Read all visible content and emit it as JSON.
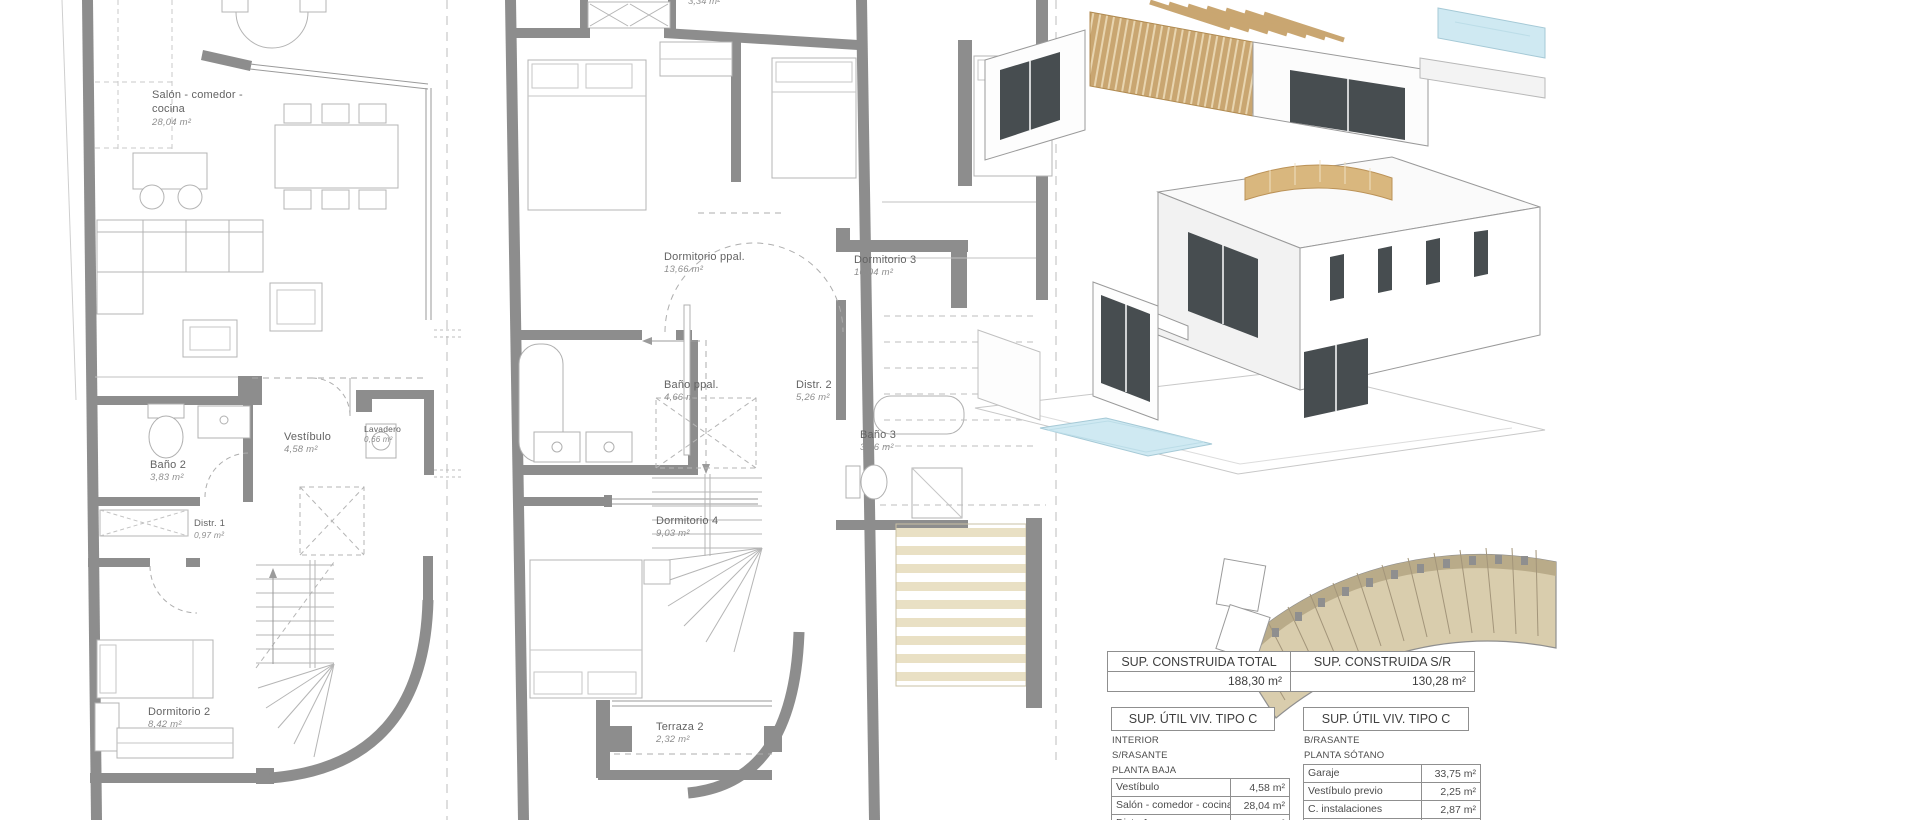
{
  "document": {
    "kind": "architectural plan sheet, vivienda tipo C"
  },
  "colors": {
    "wall": "#8d8d8d",
    "line": "#b4b4b4",
    "dash": "#adadad",
    "label": "#636363",
    "area_text": "#8e8e8e",
    "wood": "#c9a671",
    "roof_wood": "#d9b77e",
    "pool": "#cfe9f2",
    "glass": "#474d50",
    "site_beige": "#d9cdad",
    "stair_beige": "#e9e0c4"
  },
  "plans": {
    "ground": {
      "rooms": [
        {
          "name": "Salón - comedor - cocina",
          "area": "28,04 m²"
        },
        {
          "name": "Baño 2",
          "area": "3,83 m²"
        },
        {
          "name": "Vestíbulo",
          "area": "4,58 m²"
        },
        {
          "name": "Lavadero",
          "area": "0,66 m²"
        },
        {
          "name": "Distr. 1",
          "area": "0,97 m²"
        },
        {
          "name": "Dormitorio 2",
          "area": "8,42 m²"
        }
      ]
    },
    "upper": {
      "partial_area": "3,34 m²",
      "rooms": [
        {
          "name": "Dormitorio ppal.",
          "area": "13,66 m²"
        },
        {
          "name": "Dormitorio 3",
          "area": "10,04 m²"
        },
        {
          "name": "Baño ppal.",
          "area": "4,66 m²"
        },
        {
          "name": "Distr. 2",
          "area": "5,26 m²"
        },
        {
          "name": "Baño 3",
          "area": "3,36 m²"
        },
        {
          "name": "Dormitorio 4",
          "area": "9,03 m²"
        },
        {
          "name": "Terraza 2",
          "area": "2,32 m²"
        }
      ]
    }
  },
  "tables": {
    "summary": {
      "col1_header": "SUP. CONSTRUIDA TOTAL",
      "col1_value": "188,30 m²",
      "col2_header": "SUP. CONSTRUIDA S/R",
      "col2_value": "130,28 m²"
    },
    "util_left": {
      "title": "SUP. ÚTIL VIV. TIPO C",
      "meta1": "INTERIOR",
      "meta2": "S/RASANTE",
      "meta3": "PLANTA BAJA",
      "rows": [
        {
          "label": "Vestíbulo",
          "value": "4,58 m²"
        },
        {
          "label": "Salón - comedor - cocina",
          "value": "28,04 m²"
        },
        {
          "label": "Distr. 1",
          "value": "0,97 m²"
        }
      ]
    },
    "util_right": {
      "title": "SUP. ÚTIL VIV. TIPO C",
      "meta1": "B/RASANTE",
      "meta2": "PLANTA SÓTANO",
      "rows": [
        {
          "label": "Garaje",
          "value": "33,75 m²"
        },
        {
          "label": "Vestíbulo previo",
          "value": "2,25 m²"
        },
        {
          "label": "C. instalaciones",
          "value": "2,87 m²"
        },
        {
          "label": "",
          "value": "38,88 m²"
        }
      ]
    }
  }
}
